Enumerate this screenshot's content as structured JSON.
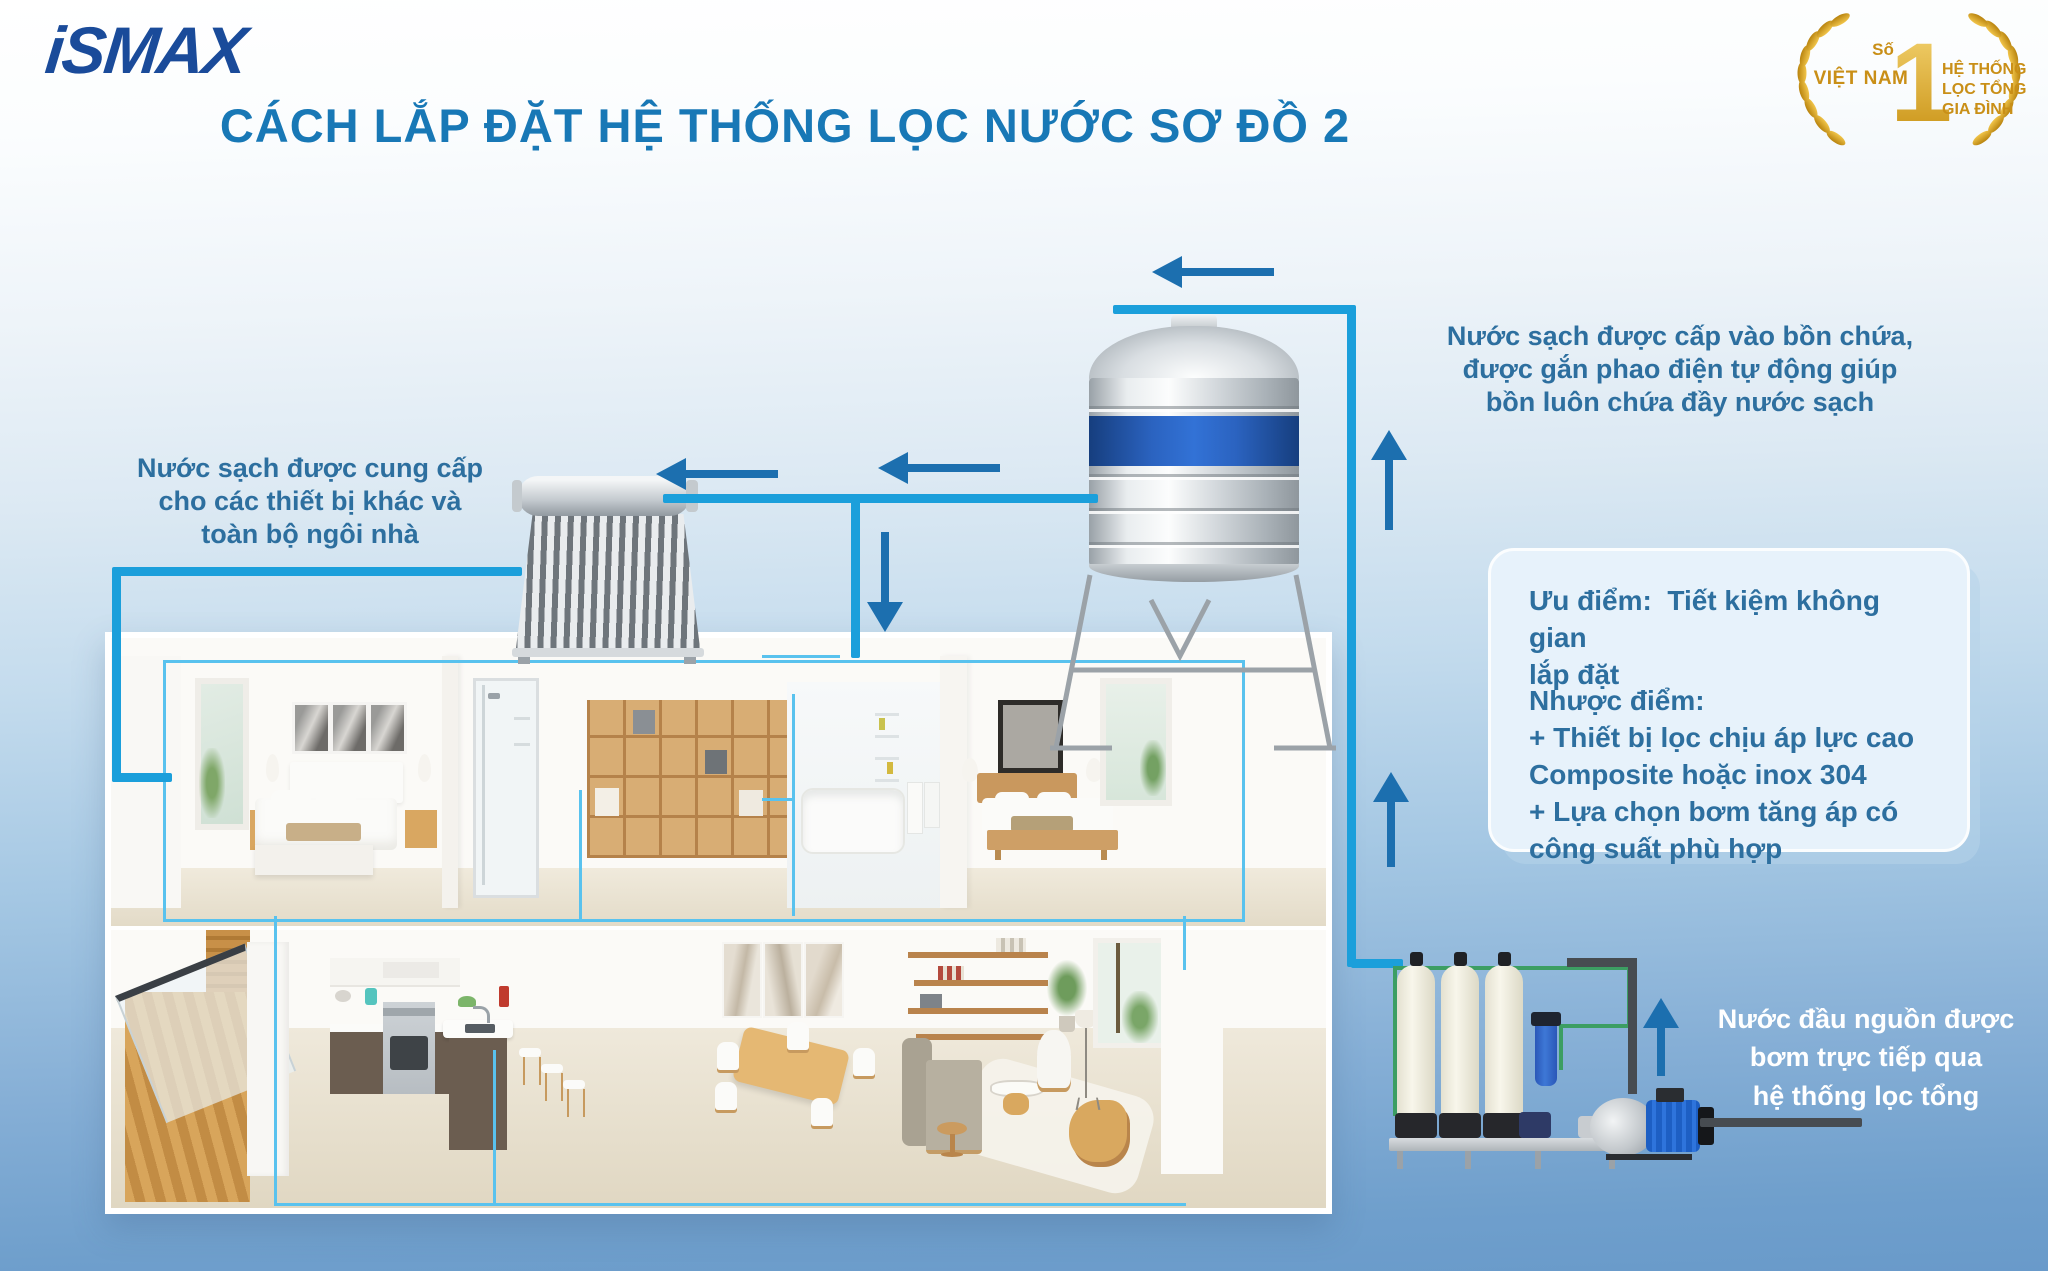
{
  "title": "CÁCH LẮP ĐẶT HỆ THỐNG LỌC NƯỚC SƠ ĐỒ 2",
  "brand": {
    "logo": "iSMAX"
  },
  "award_badge": {
    "left_top": "Số",
    "left_bottom": "VIỆT NAM",
    "rank": "1",
    "right_lines": [
      "HỆ THỐNG",
      "LỌC TỔNG",
      "GIA ĐÌNH"
    ]
  },
  "annotations": {
    "tank_inlet": {
      "lines": [
        "Nước sạch được cấp vào bồn chứa,",
        "được gắn phao điện tự động giúp",
        "bồn luôn chứa đầy nước sạch"
      ]
    },
    "house_supply": {
      "lines": [
        "Nước sạch được cung cấp",
        "cho các thiết bị khác và",
        "toàn bộ ngôi nhà"
      ]
    },
    "source_pump": {
      "lines": [
        "Nước đầu nguồn được",
        "bơm trực tiếp qua",
        "hệ thống lọc tổng"
      ]
    }
  },
  "info_box": {
    "pros_lines": [
      "Ưu điểm:  Tiết kiệm không gian",
      "lắp đặt"
    ],
    "cons_lines": [
      "Nhược điểm:",
      "+ Thiết bị lọc chịu áp lực cao",
      "Composite hoặc inox 304",
      "+ Lựa chọn bơm tăng áp có",
      "công suất phù hợp"
    ]
  },
  "colors": {
    "title_blue": "#1878B6",
    "logo_navy": "#1A4B9A",
    "annotation_blue": "#2D6F9F",
    "pipe_blue": "#1B9FDB",
    "pipe_thin_blue": "#59C2EE",
    "arrow_blue": "#1C6FAF",
    "pipe_green": "#3C9E63",
    "pipe_dark": "#4A4F54",
    "gold": "#D9A425",
    "tank_band_blue": "#2B63C0",
    "info_box_bg": "#E7F2FB",
    "white_text": "#FFFFFF"
  }
}
